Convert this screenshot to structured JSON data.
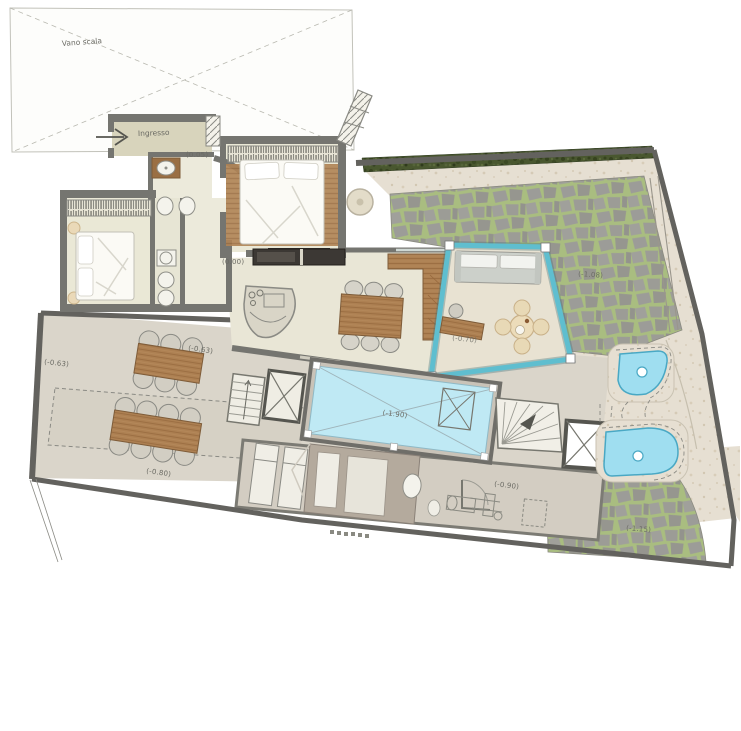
{
  "plan": {
    "title": "villa-ground-floor-plan",
    "texts": {
      "stairwell": "Vano scala",
      "entrance": "Ingresso"
    },
    "levels": {
      "entrance": "(0.05)",
      "living": "(0.00)",
      "terrace_left": "(-0.63)",
      "terrace_upper": "(-0.63)",
      "terrace_lower": "(-0.80)",
      "pool": "(-1.90)",
      "stone_terrace": "(-1.08)",
      "veranda": "(-0.70)",
      "gym_room": "(-0.90)",
      "stone_lower": "(-1.15)"
    },
    "colors": {
      "wall": "#6f6e69",
      "floor": "#eae7d7",
      "terrace": "#dad5ca",
      "travertine": "#e6dfd2",
      "stone": "#9c9c98",
      "stone_joint": "#a9bd80",
      "hedge": "#49572f",
      "wood": "#ad8052",
      "pool_water": "#bfe9f4",
      "pond_water": "#9fdef0",
      "veranda_frame": "#5fbecf"
    }
  }
}
